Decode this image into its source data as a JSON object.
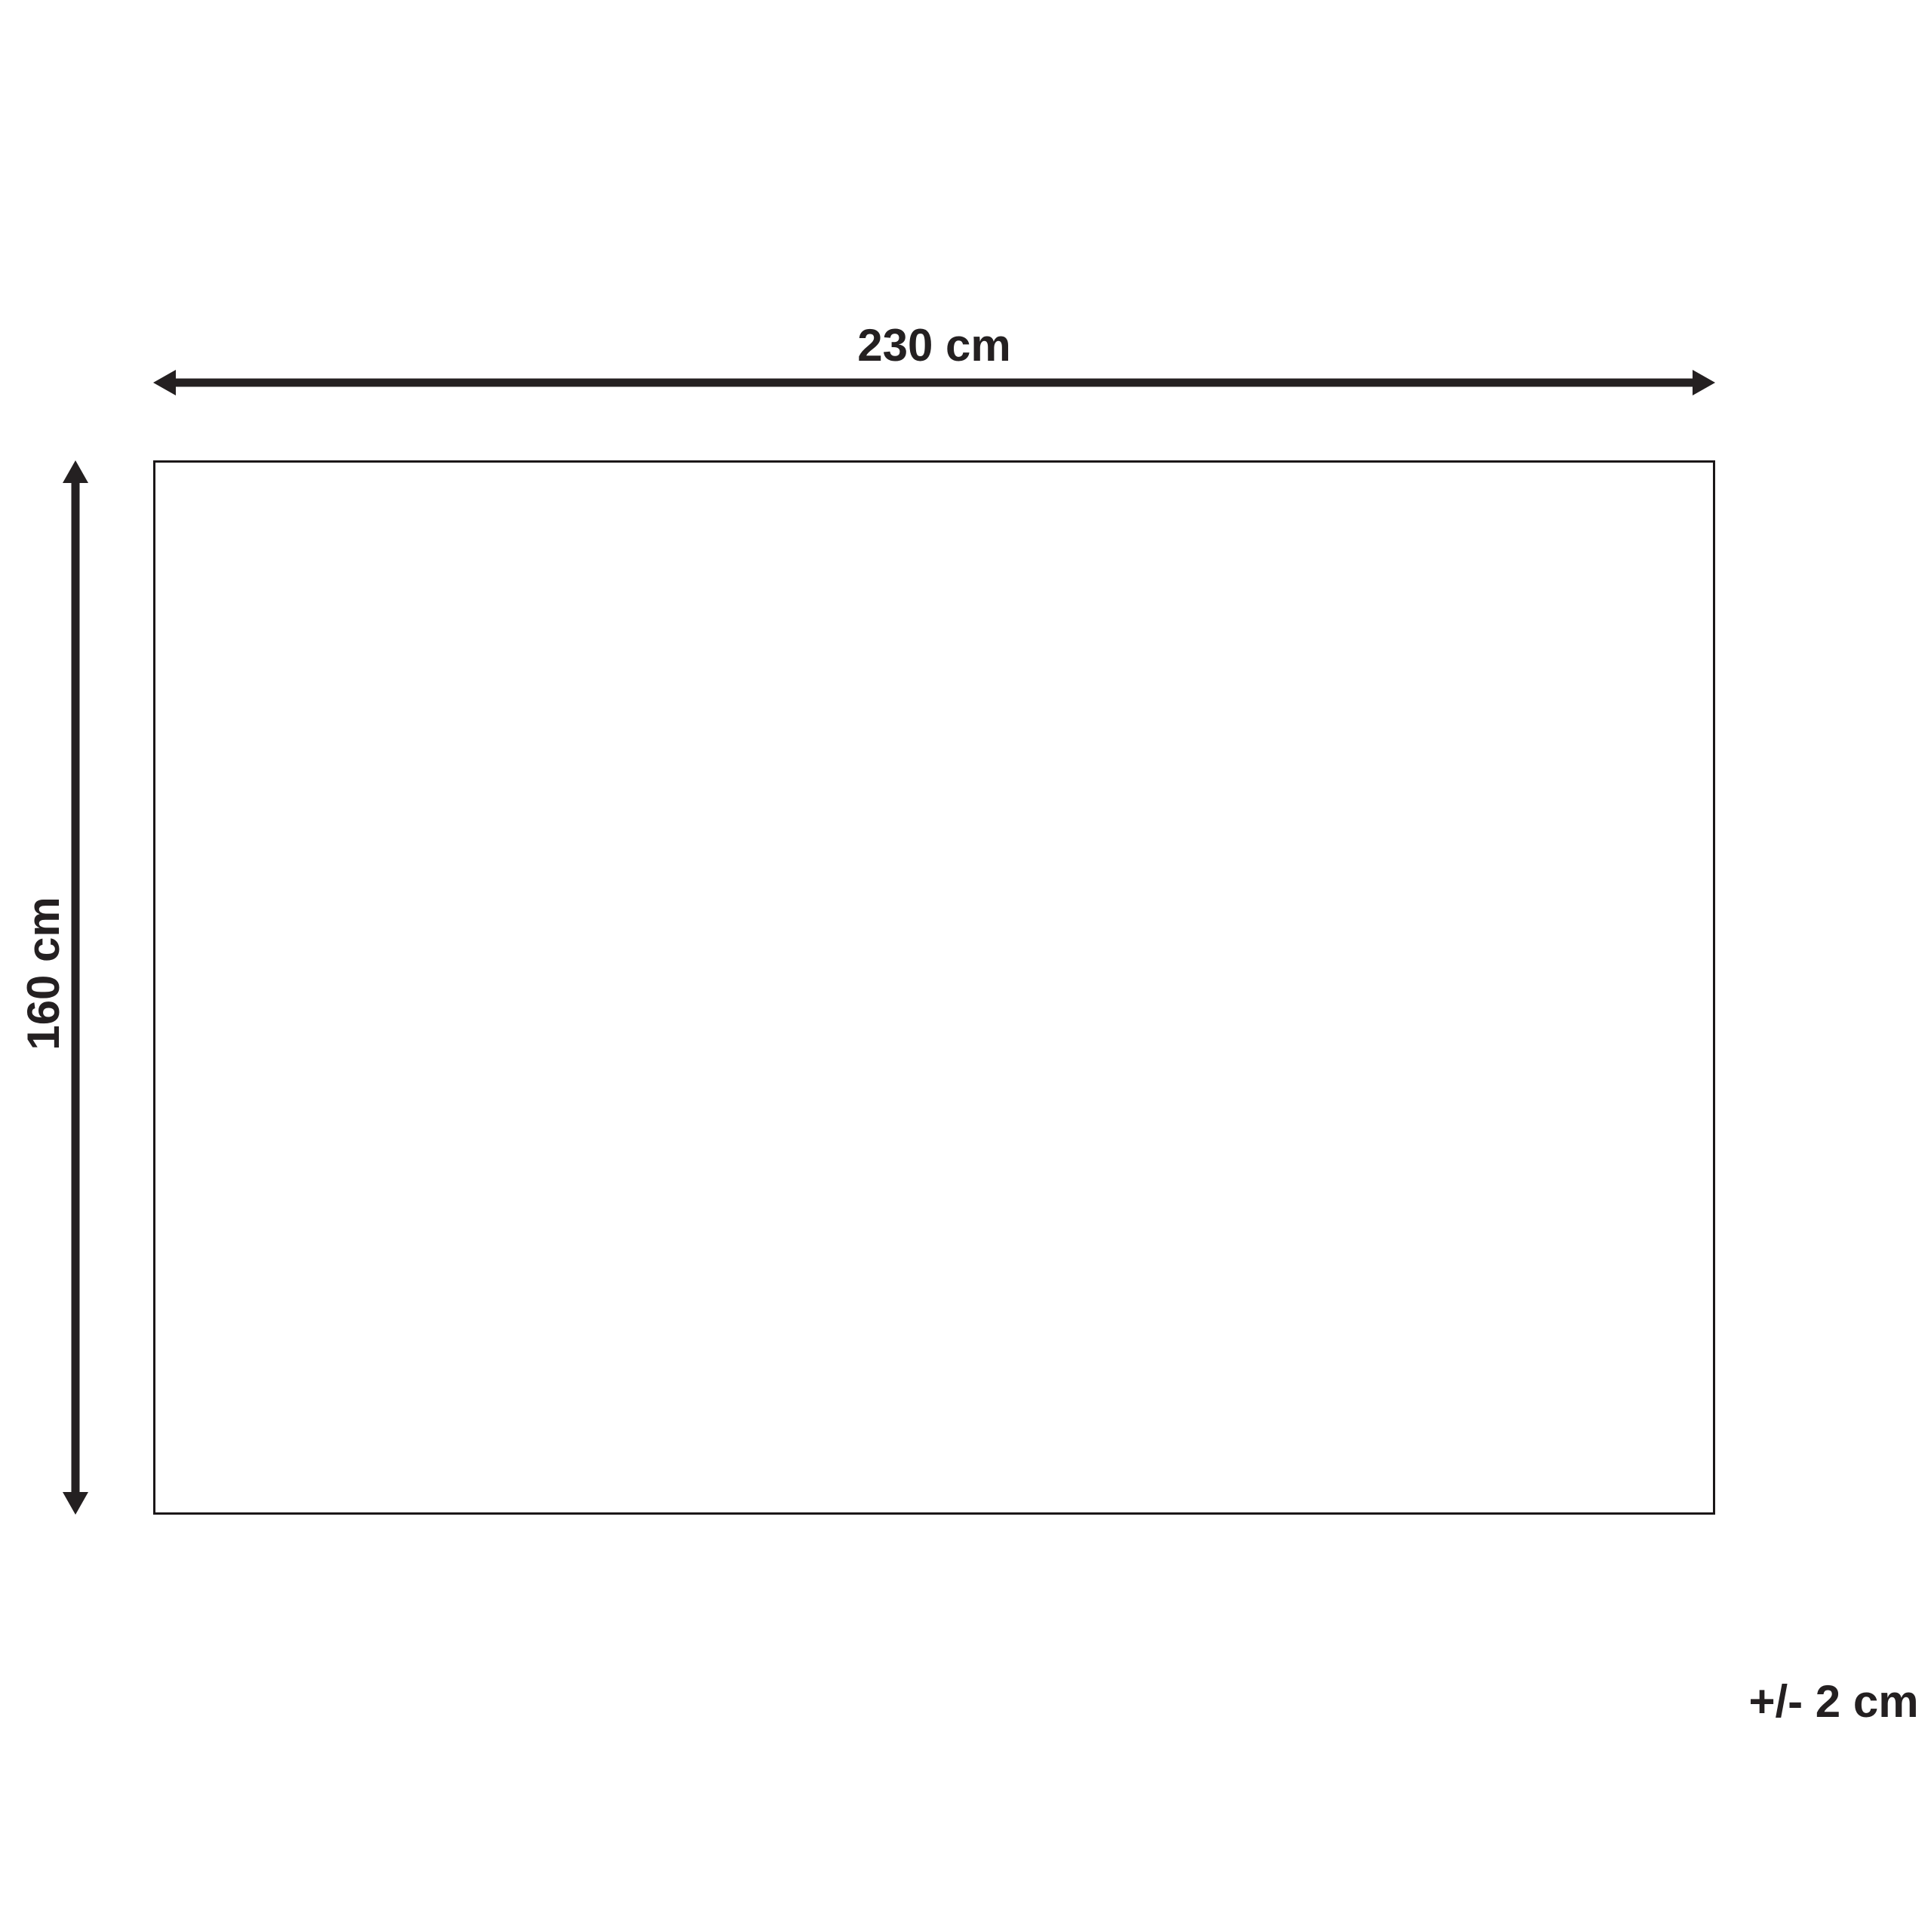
{
  "diagram": {
    "width_label": "230 cm",
    "height_label": "160 cm",
    "tolerance_label": "+/- 2 cm",
    "dimensions": {
      "width_cm": 230,
      "height_cm": 160,
      "tolerance_cm": 2
    }
  },
  "colors": {
    "ink": "#242021",
    "outline": "#1b1718",
    "background": "#ffffff"
  }
}
